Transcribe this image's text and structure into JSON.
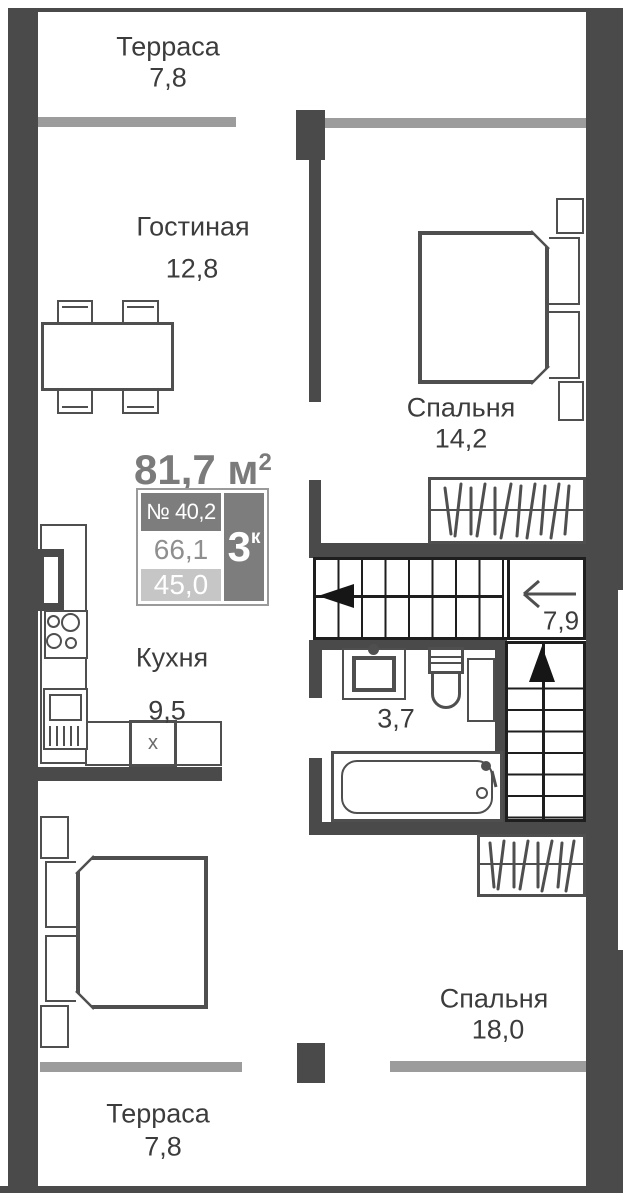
{
  "rooms": {
    "terrace_top": {
      "label": "Терраса",
      "area": "7,8"
    },
    "living_room": {
      "label": "Гостиная",
      "area": "12,8"
    },
    "bedroom_top": {
      "label": "Спальня",
      "area": "14,2"
    },
    "kitchen": {
      "label": "Кухня",
      "area": "9,5"
    },
    "bathroom": {
      "area": "3,7"
    },
    "stairs": {
      "area": "7,9"
    },
    "bedroom_bottom": {
      "label": "Спальня",
      "area": "18,0"
    },
    "terrace_bottom": {
      "label": "Терраса",
      "area": "7,8"
    }
  },
  "info_card": {
    "total_area_text": "81,7 м",
    "total_area_sup": "2",
    "unit_number": "№ 40,2",
    "rooms_count": "3",
    "rooms_count_sup": "к",
    "area_living": "66,1",
    "area_secondary": "45,0"
  },
  "fixtures": {
    "kitchen_sink_label": "x"
  },
  "colors": {
    "wall": "#4a4a4a",
    "window": "#9c9c9c",
    "line": "#4f4f4f",
    "stairs_line": "#1e1e1e",
    "text": "#3c3c3c",
    "info_dark": "#7d7d7d",
    "info_light": "#c6c6c6",
    "info_muted": "#8f8f8f",
    "info_border": "#9a9a9a"
  }
}
